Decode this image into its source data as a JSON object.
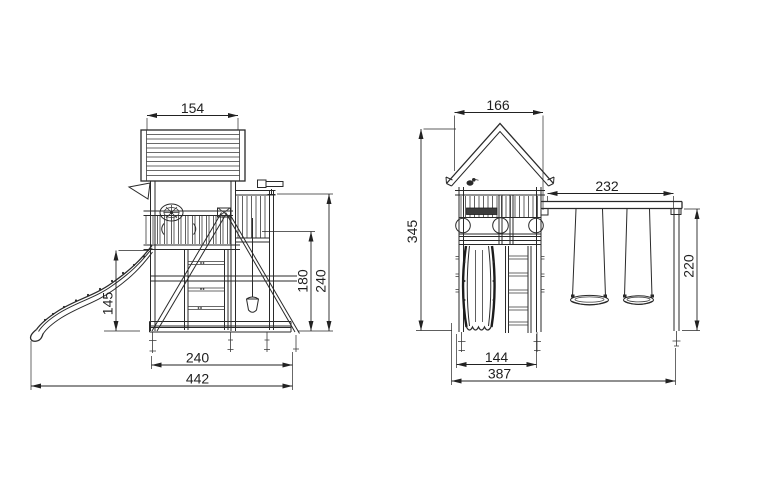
{
  "meta": {
    "type": "technical-drawing",
    "subject": "wooden playground tower with slide and double swing",
    "background": "#ffffff",
    "line_color": "#2a2a2a"
  },
  "views": {
    "side": {
      "label": "side-elevation",
      "dims": {
        "roof_width": "154",
        "platform_height": "145",
        "swing_beam_height": "180",
        "balcony_rail_height": "240",
        "swing_base_depth": "240",
        "overall_length": "442"
      }
    },
    "front": {
      "label": "front-elevation",
      "dims": {
        "roof_width": "166",
        "overall_height": "345",
        "swing_beam_length": "232",
        "swing_frame_height": "220",
        "tower_width": "144",
        "overall_width": "387"
      }
    }
  }
}
